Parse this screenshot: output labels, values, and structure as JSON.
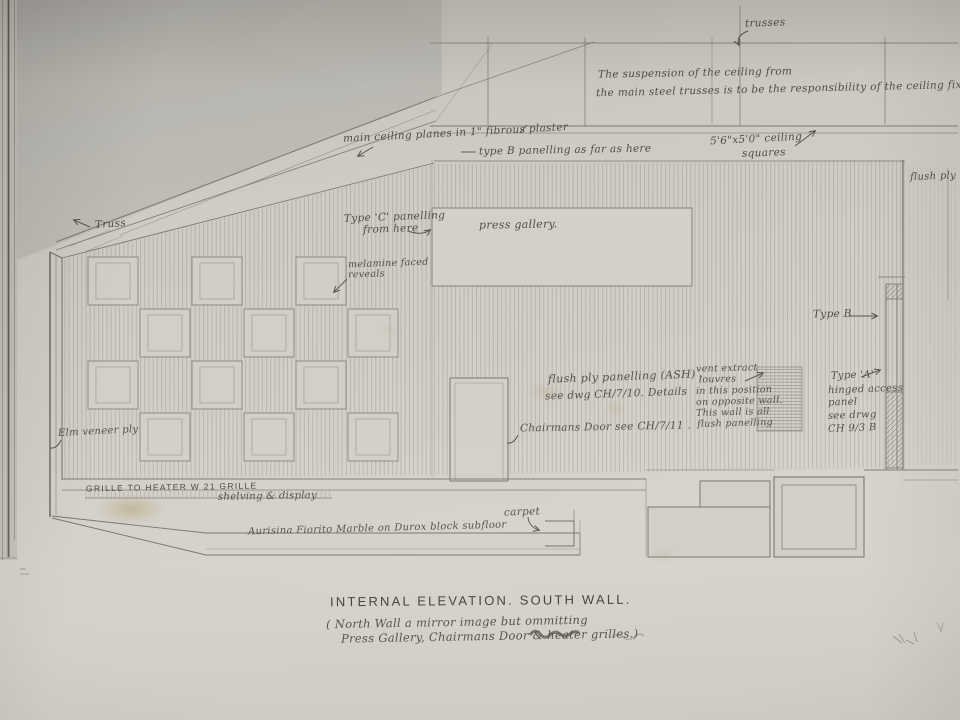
{
  "drawing": {
    "title": "INTERNAL ELEVATION.    SOUTH WALL.",
    "subtitle_line1": "( North Wall  a mirror image but ommitting",
    "subtitle_line2": "Press Gallery, Chairmans Door  &  heater  grilles.)",
    "colors": {
      "pencil": "#4f4d48",
      "paper": "#cfccc5",
      "stain": "#a98c4f"
    },
    "annotations": {
      "trusses": "trusses",
      "ceiling_resp_1": "The suspension of the ceiling from",
      "ceiling_resp_2": "the main steel trusses is to be the responsibility of the ceiling fixer",
      "ceiling_planes": "main ceiling planes in 1\" fibrous plaster",
      "type_b_top": "type B panelling   as far as here",
      "ceiling_squares_1": "5'6\"x5'0\" ceiling",
      "ceiling_squares_2": "squares",
      "truss": "Truss",
      "type_c_1": "Type 'C' panelling",
      "type_c_2": "from here",
      "press_gallery": "press gallery.",
      "melamine_1": "melamine faced",
      "melamine_2": "reveals",
      "flush_ply_edge": "flush ply p",
      "type_b_right": "Type B",
      "flush_ash_1": "flush ply panelling (ASH) .",
      "flush_ash_2": "see dwg CH/7/10.   Details",
      "vent_lines": [
        "vent extract",
        "louvres",
        "in this position",
        "on opposite wall.",
        "This wall is all",
        "flush panelling"
      ],
      "type_a_lines": [
        "Type 'A'",
        "hinged access",
        "panel",
        "see drwg",
        "CH 9/3 B"
      ],
      "chairmans_door": "Chairmans Door see CH/7/11 .",
      "elm": "Elm veneer ply",
      "grille": "GRILLE  TO  HEATER  W 21  GRILLE",
      "shelving": "shelving  &  display",
      "carpet": "carpet",
      "marble": "Aurisina Fiorito Marble on Durox block subfloor"
    }
  }
}
